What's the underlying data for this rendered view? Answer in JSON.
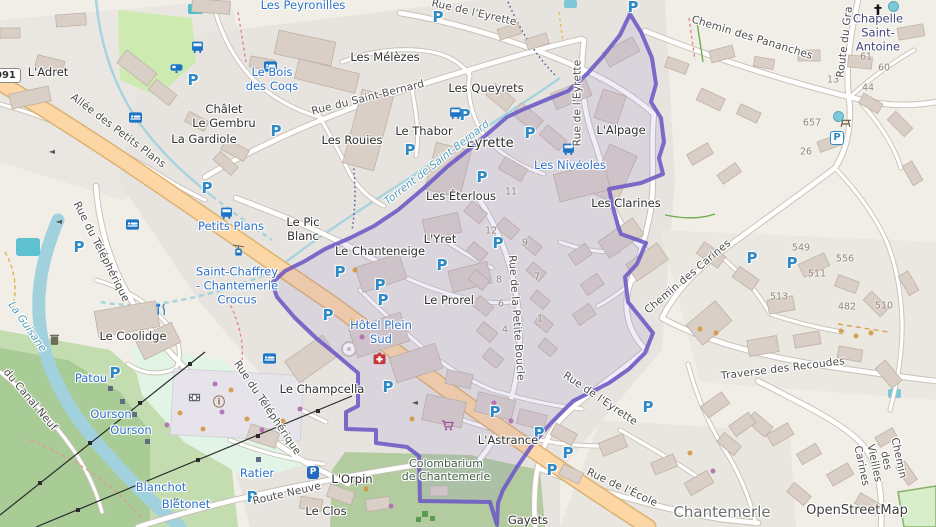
{
  "map": {
    "attribution": "OpenStreetMap",
    "road_shield": "091",
    "parking_glyph": "P",
    "colors": {
      "boundary_purple": "#6c59c5",
      "boundary_fill": "#8f7fd6",
      "parking_blue": "#2e89c4",
      "tourism_blue": "#2d72c8",
      "main_road_orange": "#fcd6a4",
      "water": "#aad3df",
      "forest_green": "#a9cc96",
      "stream_label_teal": "#559fbb"
    },
    "labels": [
      {
        "t": "Les Peyronilles",
        "x": 303,
        "y": 6,
        "cls": "blue",
        "name": "label-les-peyronilles"
      },
      {
        "t": "Le Bois\ndes Coqs",
        "x": 272,
        "y": 80,
        "cls": "blue",
        "name": "label-le-bois-des-coqs"
      },
      {
        "t": "Petits Plans",
        "x": 231,
        "y": 227,
        "cls": "blue",
        "name": "label-petits-plans-stop"
      },
      {
        "t": "Les Nivéoles",
        "x": 570,
        "y": 166,
        "cls": "blue",
        "name": "label-les-niveoles"
      },
      {
        "t": "Saint-Chaffrey\n- Chantemerle\nCrocus",
        "x": 237,
        "y": 286,
        "cls": "blue",
        "name": "label-saint-chaffrey-chantemerle-crocus"
      },
      {
        "t": "Hôtel Plein\nSud",
        "x": 381,
        "y": 333,
        "cls": "blue",
        "name": "label-hotel-plein-sud"
      },
      {
        "t": "Patou",
        "x": 91,
        "y": 379,
        "cls": "blue",
        "name": "label-patou"
      },
      {
        "t": "Ourson",
        "x": 111,
        "y": 415,
        "cls": "blue",
        "name": "label-ourson-1"
      },
      {
        "t": "Ourson",
        "x": 131,
        "y": 431,
        "cls": "blue",
        "name": "label-ourson-2"
      },
      {
        "t": "Blanchot",
        "x": 161,
        "y": 488,
        "cls": "blue",
        "name": "label-blanchot"
      },
      {
        "t": "Blétonet",
        "x": 186,
        "y": 505,
        "cls": "blue",
        "name": "label-bletonet"
      },
      {
        "t": "Ratier",
        "x": 257,
        "y": 474,
        "cls": "blue",
        "name": "label-ratier"
      },
      {
        "t": "L'Adret",
        "x": 48,
        "y": 73,
        "cls": "place",
        "name": "label-l-adret"
      },
      {
        "t": "Les Mélèzes",
        "x": 385,
        "y": 58,
        "cls": "place",
        "name": "label-les-melezes"
      },
      {
        "t": "Châlet\nLe Gembru",
        "x": 224,
        "y": 117,
        "cls": "place",
        "name": "label-chalet-le-gembru"
      },
      {
        "t": "La Gardiole",
        "x": 204,
        "y": 140,
        "cls": "place",
        "name": "label-la-gardiole"
      },
      {
        "t": "Les Rouies",
        "x": 352,
        "y": 141,
        "cls": "place",
        "name": "label-les-rouies"
      },
      {
        "t": "Le Thabor",
        "x": 424,
        "y": 132,
        "cls": "place",
        "name": "label-le-thabor"
      },
      {
        "t": "Les Queyrets",
        "x": 486,
        "y": 89,
        "cls": "place",
        "name": "label-les-queyrets"
      },
      {
        "t": "Eyrette",
        "x": 490,
        "y": 144,
        "cls": "hamlet",
        "name": "label-eyrette"
      },
      {
        "t": "L'Alpage",
        "x": 621,
        "y": 131,
        "cls": "place",
        "name": "label-l-alpage"
      },
      {
        "t": "Les Éterlous",
        "x": 461,
        "y": 197,
        "cls": "place",
        "name": "label-les-eterlous"
      },
      {
        "t": "Les Clarines",
        "x": 626,
        "y": 204,
        "cls": "place",
        "name": "label-les-clarines"
      },
      {
        "t": "Le Pic\nBlanc",
        "x": 303,
        "y": 230,
        "cls": "place",
        "name": "label-le-pic-blanc"
      },
      {
        "t": "Le Chanteneige",
        "x": 380,
        "y": 252,
        "cls": "place",
        "name": "label-le-chanteneige"
      },
      {
        "t": "L'Yret",
        "x": 440,
        "y": 240,
        "cls": "place",
        "name": "label-l-yret"
      },
      {
        "t": "Le Prorel",
        "x": 449,
        "y": 301,
        "cls": "place",
        "name": "label-le-prorel"
      },
      {
        "t": "Le Coolidge",
        "x": 133,
        "y": 337,
        "cls": "place",
        "name": "label-le-coolidge"
      },
      {
        "t": "Le Champcella",
        "x": 322,
        "y": 390,
        "cls": "place",
        "name": "label-le-champcella"
      },
      {
        "t": "L'Astrance",
        "x": 508,
        "y": 441,
        "cls": "place",
        "name": "label-l-astrance"
      },
      {
        "t": "L'Orpin",
        "x": 352,
        "y": 480,
        "cls": "place",
        "name": "label-l-orpin"
      },
      {
        "t": "Le Clos",
        "x": 326,
        "y": 512,
        "cls": "place",
        "name": "label-le-clos"
      },
      {
        "t": "Gayets",
        "x": 528,
        "y": 521,
        "cls": "place",
        "name": "label-gayets"
      },
      {
        "t": "Chapelle\nSaint-Antoine",
        "x": 878,
        "y": 33,
        "cls": "church-label",
        "name": "label-chapelle-saint-antoine"
      },
      {
        "t": "Colombarium\nde Chantemerle",
        "x": 446,
        "y": 470,
        "cls": "cemetery-label",
        "name": "label-colombarium-de-chantemerle"
      },
      {
        "t": "Chantemerle",
        "x": 722,
        "y": 512,
        "cls": "city",
        "name": "label-chantemerle"
      },
      {
        "t": "OpenStreetMap",
        "x": 857,
        "y": 511,
        "cls": "attribution",
        "name": "map-attribution"
      },
      {
        "t": "Allée des Petits Plans",
        "x": 118,
        "y": 131,
        "rot": 37,
        "cls": "street",
        "name": "street-allee-des-petits-plans"
      },
      {
        "t": "Rue du Saint-Bernard",
        "x": 368,
        "y": 98,
        "rot": -14,
        "cls": "street",
        "name": "street-rue-du-saint-bernard"
      },
      {
        "t": "Rue de l'Eyrette",
        "x": 474,
        "y": 13,
        "rot": 13,
        "cls": "street",
        "name": "street-rue-de-l-eyrette-top"
      },
      {
        "t": "Rue de l'Eyrette",
        "x": 578,
        "y": 103,
        "rot": -90,
        "cls": "street",
        "name": "street-rue-de-l-eyrette-vertical"
      },
      {
        "t": "Chemin des Pananches",
        "x": 752,
        "y": 38,
        "rot": 17,
        "cls": "street",
        "name": "street-chemin-des-pananches"
      },
      {
        "t": "Route du Gra",
        "x": 845,
        "y": 42,
        "rot": -83,
        "cls": "street",
        "name": "street-route-du-grand"
      },
      {
        "t": "Rue du Téléphérique",
        "x": 101,
        "y": 252,
        "rot": 63,
        "cls": "street",
        "name": "street-rue-du-telepherique-1"
      },
      {
        "t": "Rue du Téléphérique",
        "x": 267,
        "y": 408,
        "rot": 56,
        "cls": "street",
        "name": "street-rue-du-telepherique-2"
      },
      {
        "t": "Rue de la Petite Boucle",
        "x": 516,
        "y": 318,
        "rot": 86,
        "cls": "street",
        "name": "street-rue-de-la-petite-boucle"
      },
      {
        "t": "Chemin des Carines",
        "x": 688,
        "y": 277,
        "rot": -40,
        "cls": "street",
        "name": "street-chemin-des-carines"
      },
      {
        "t": "Traverse des Recoudes",
        "x": 783,
        "y": 369,
        "rot": -7,
        "cls": "street",
        "name": "street-traverse-des-recoudes"
      },
      {
        "t": "Rue de l'Eyrette",
        "x": 600,
        "y": 399,
        "rot": 34,
        "cls": "street",
        "name": "street-rue-de-l-eyrette-bottom"
      },
      {
        "t": "Rue de l'École",
        "x": 622,
        "y": 488,
        "rot": 25,
        "cls": "street",
        "name": "street-rue-de-l-ecole"
      },
      {
        "t": "Route Neuve",
        "x": 287,
        "y": 494,
        "rot": -13,
        "cls": "street",
        "name": "street-route-neuve"
      },
      {
        "t": "du Canal Neuf",
        "x": 30,
        "y": 400,
        "rot": 50,
        "cls": "street",
        "name": "street-du-canal-neuf"
      },
      {
        "t": "Chemin des Vieilles Carines",
        "x": 880,
        "y": 462,
        "rot": 78,
        "cls": "street",
        "name": "street-chemin-des-vieilles-carines"
      },
      {
        "t": "Torrent de Saint-Bernard",
        "x": 437,
        "y": 163,
        "rot": -38,
        "cls": "water",
        "name": "stream-torrent-de-saint-bernard"
      },
      {
        "t": "La Guisane",
        "x": 27,
        "y": 327,
        "rot": 55,
        "cls": "water",
        "name": "river-la-guisane"
      }
    ],
    "icons": [
      {
        "type": "parking",
        "x": 438,
        "y": 17
      },
      {
        "type": "parking",
        "x": 633,
        "y": 7
      },
      {
        "type": "parking",
        "x": 193,
        "y": 80
      },
      {
        "type": "parking",
        "x": 276,
        "y": 131
      },
      {
        "type": "parking",
        "x": 207,
        "y": 188
      },
      {
        "type": "parking",
        "x": 79,
        "y": 247
      },
      {
        "type": "parking",
        "x": 410,
        "y": 150
      },
      {
        "type": "parking",
        "x": 465,
        "y": 115
      },
      {
        "type": "parking",
        "x": 482,
        "y": 177
      },
      {
        "type": "parking",
        "x": 530,
        "y": 133
      },
      {
        "type": "parking",
        "x": 340,
        "y": 272
      },
      {
        "type": "parking",
        "x": 380,
        "y": 285
      },
      {
        "type": "parking",
        "x": 383,
        "y": 300
      },
      {
        "type": "parking",
        "x": 328,
        "y": 315
      },
      {
        "type": "parking",
        "x": 442,
        "y": 265
      },
      {
        "type": "parking",
        "x": 498,
        "y": 243
      },
      {
        "type": "parking",
        "x": 752,
        "y": 258
      },
      {
        "type": "parking",
        "x": 792,
        "y": 263
      },
      {
        "type": "parking",
        "x": 115,
        "y": 373
      },
      {
        "type": "parking",
        "x": 252,
        "y": 497
      },
      {
        "type": "parking",
        "x": 388,
        "y": 387
      },
      {
        "type": "parking",
        "x": 495,
        "y": 412
      },
      {
        "type": "parking",
        "x": 539,
        "y": 433
      },
      {
        "type": "parking",
        "x": 568,
        "y": 453
      },
      {
        "type": "parking",
        "x": 552,
        "y": 470
      },
      {
        "type": "parking",
        "x": 648,
        "y": 407
      },
      {
        "type": "parking-out",
        "x": 837,
        "y": 138
      },
      {
        "type": "parking-box",
        "x": 313,
        "y": 472
      },
      {
        "type": "bus",
        "x": 199,
        "y": 48
      },
      {
        "type": "bus",
        "x": 457,
        "y": 114
      },
      {
        "type": "bus",
        "x": 228,
        "y": 214
      },
      {
        "type": "bus",
        "x": 570,
        "y": 150
      },
      {
        "type": "caravan",
        "x": 178,
        "y": 69
      },
      {
        "type": "bed",
        "x": 272,
        "y": 68
      },
      {
        "type": "bed",
        "x": 137,
        "y": 119
      },
      {
        "type": "bed",
        "x": 134,
        "y": 226
      },
      {
        "type": "bed",
        "x": 271,
        "y": 360
      },
      {
        "type": "church",
        "x": 878,
        "y": 10
      },
      {
        "type": "gondola",
        "x": 240,
        "y": 252
      },
      {
        "type": "restaurant",
        "x": 163,
        "y": 311
      },
      {
        "type": "cinema",
        "x": 196,
        "y": 399
      },
      {
        "type": "info",
        "x": 219,
        "y": 401
      },
      {
        "type": "pharmacy",
        "x": 381,
        "y": 360
      },
      {
        "type": "cart",
        "x": 449,
        "y": 427
      },
      {
        "type": "picnic",
        "x": 847,
        "y": 124
      },
      {
        "type": "waste",
        "x": 56,
        "y": 341
      },
      {
        "type": "fountain",
        "x": 838,
        "y": 116
      },
      {
        "type": "fountain",
        "x": 893,
        "y": 6
      },
      {
        "type": "arrow",
        "x": 52,
        "y": 151
      },
      {
        "type": "arrow",
        "x": 59,
        "y": 221
      },
      {
        "type": "arrow",
        "x": 415,
        "y": 402
      },
      {
        "type": "arrow",
        "x": 438,
        "y": 477
      },
      {
        "type": "marker-sq",
        "x": 110,
        "y": 388
      },
      {
        "type": "marker-sq",
        "x": 122,
        "y": 401
      },
      {
        "type": "marker-sq",
        "x": 134,
        "y": 414
      },
      {
        "type": "marker-sq",
        "x": 147,
        "y": 441
      },
      {
        "type": "marker-sq",
        "x": 258,
        "y": 459
      },
      {
        "type": "marker-sq",
        "x": 176,
        "y": 500
      }
    ],
    "house_numbers": [
      {
        "n": "61",
        "x": 866,
        "y": 57
      },
      {
        "n": "60",
        "x": 884,
        "y": 68
      },
      {
        "n": "13",
        "x": 833,
        "y": 80
      },
      {
        "n": "44",
        "x": 868,
        "y": 88
      },
      {
        "n": "657",
        "x": 812,
        "y": 123
      },
      {
        "n": "26",
        "x": 806,
        "y": 152
      },
      {
        "n": "11",
        "x": 511,
        "y": 192
      },
      {
        "n": "12",
        "x": 491,
        "y": 231
      },
      {
        "n": "9",
        "x": 525,
        "y": 243
      },
      {
        "n": "8",
        "x": 499,
        "y": 280
      },
      {
        "n": "7",
        "x": 537,
        "y": 277
      },
      {
        "n": "6",
        "x": 501,
        "y": 304
      },
      {
        "n": "1",
        "x": 540,
        "y": 319
      },
      {
        "n": "4",
        "x": 505,
        "y": 330
      },
      {
        "n": "549",
        "x": 801,
        "y": 248
      },
      {
        "n": "556",
        "x": 845,
        "y": 259
      },
      {
        "n": "511",
        "x": 817,
        "y": 274
      },
      {
        "n": "513",
        "x": 779,
        "y": 297
      },
      {
        "n": "482",
        "x": 847,
        "y": 307
      },
      {
        "n": "510",
        "x": 884,
        "y": 306
      }
    ],
    "poi_dots": [
      {
        "x": 215,
        "y": 384,
        "c": "#b06ab0"
      },
      {
        "x": 231,
        "y": 390,
        "c": "#d0983f"
      },
      {
        "x": 222,
        "y": 412,
        "c": "#b06ab0"
      },
      {
        "x": 247,
        "y": 419,
        "c": "#d0983f"
      },
      {
        "x": 203,
        "y": 429,
        "c": "#d0983f"
      },
      {
        "x": 262,
        "y": 430,
        "c": "#b06ab0"
      },
      {
        "x": 352,
        "y": 321,
        "c": "#d0983f"
      },
      {
        "x": 362,
        "y": 337,
        "c": "#b06ab0"
      },
      {
        "x": 300,
        "y": 409,
        "c": "#b06ab0"
      },
      {
        "x": 283,
        "y": 421,
        "c": "#d0983f"
      },
      {
        "x": 494,
        "y": 403,
        "c": "#b06ab0"
      },
      {
        "x": 511,
        "y": 421,
        "c": "#b06ab0"
      },
      {
        "x": 366,
        "y": 489,
        "c": "#d0983f"
      },
      {
        "x": 391,
        "y": 506,
        "c": "#b06ab0"
      },
      {
        "x": 412,
        "y": 419,
        "c": "#d0983f"
      },
      {
        "x": 700,
        "y": 329,
        "c": "#d0983f"
      },
      {
        "x": 716,
        "y": 333,
        "c": "#d0983f"
      },
      {
        "x": 668,
        "y": 291,
        "c": "#b06ab0"
      },
      {
        "x": 841,
        "y": 331,
        "c": "#d0983f"
      },
      {
        "x": 856,
        "y": 336,
        "c": "#d0983f"
      },
      {
        "x": 871,
        "y": 333,
        "c": "#d0983f"
      },
      {
        "x": 690,
        "y": 453,
        "c": "#d0983f"
      },
      {
        "x": 713,
        "y": 471,
        "c": "#b06ab0"
      },
      {
        "x": 180,
        "y": 413,
        "c": "#d0983f"
      },
      {
        "x": 355,
        "y": 270,
        "c": "#d0983f"
      },
      {
        "x": 167,
        "y": 425,
        "c": "#b06ab0"
      }
    ]
  }
}
